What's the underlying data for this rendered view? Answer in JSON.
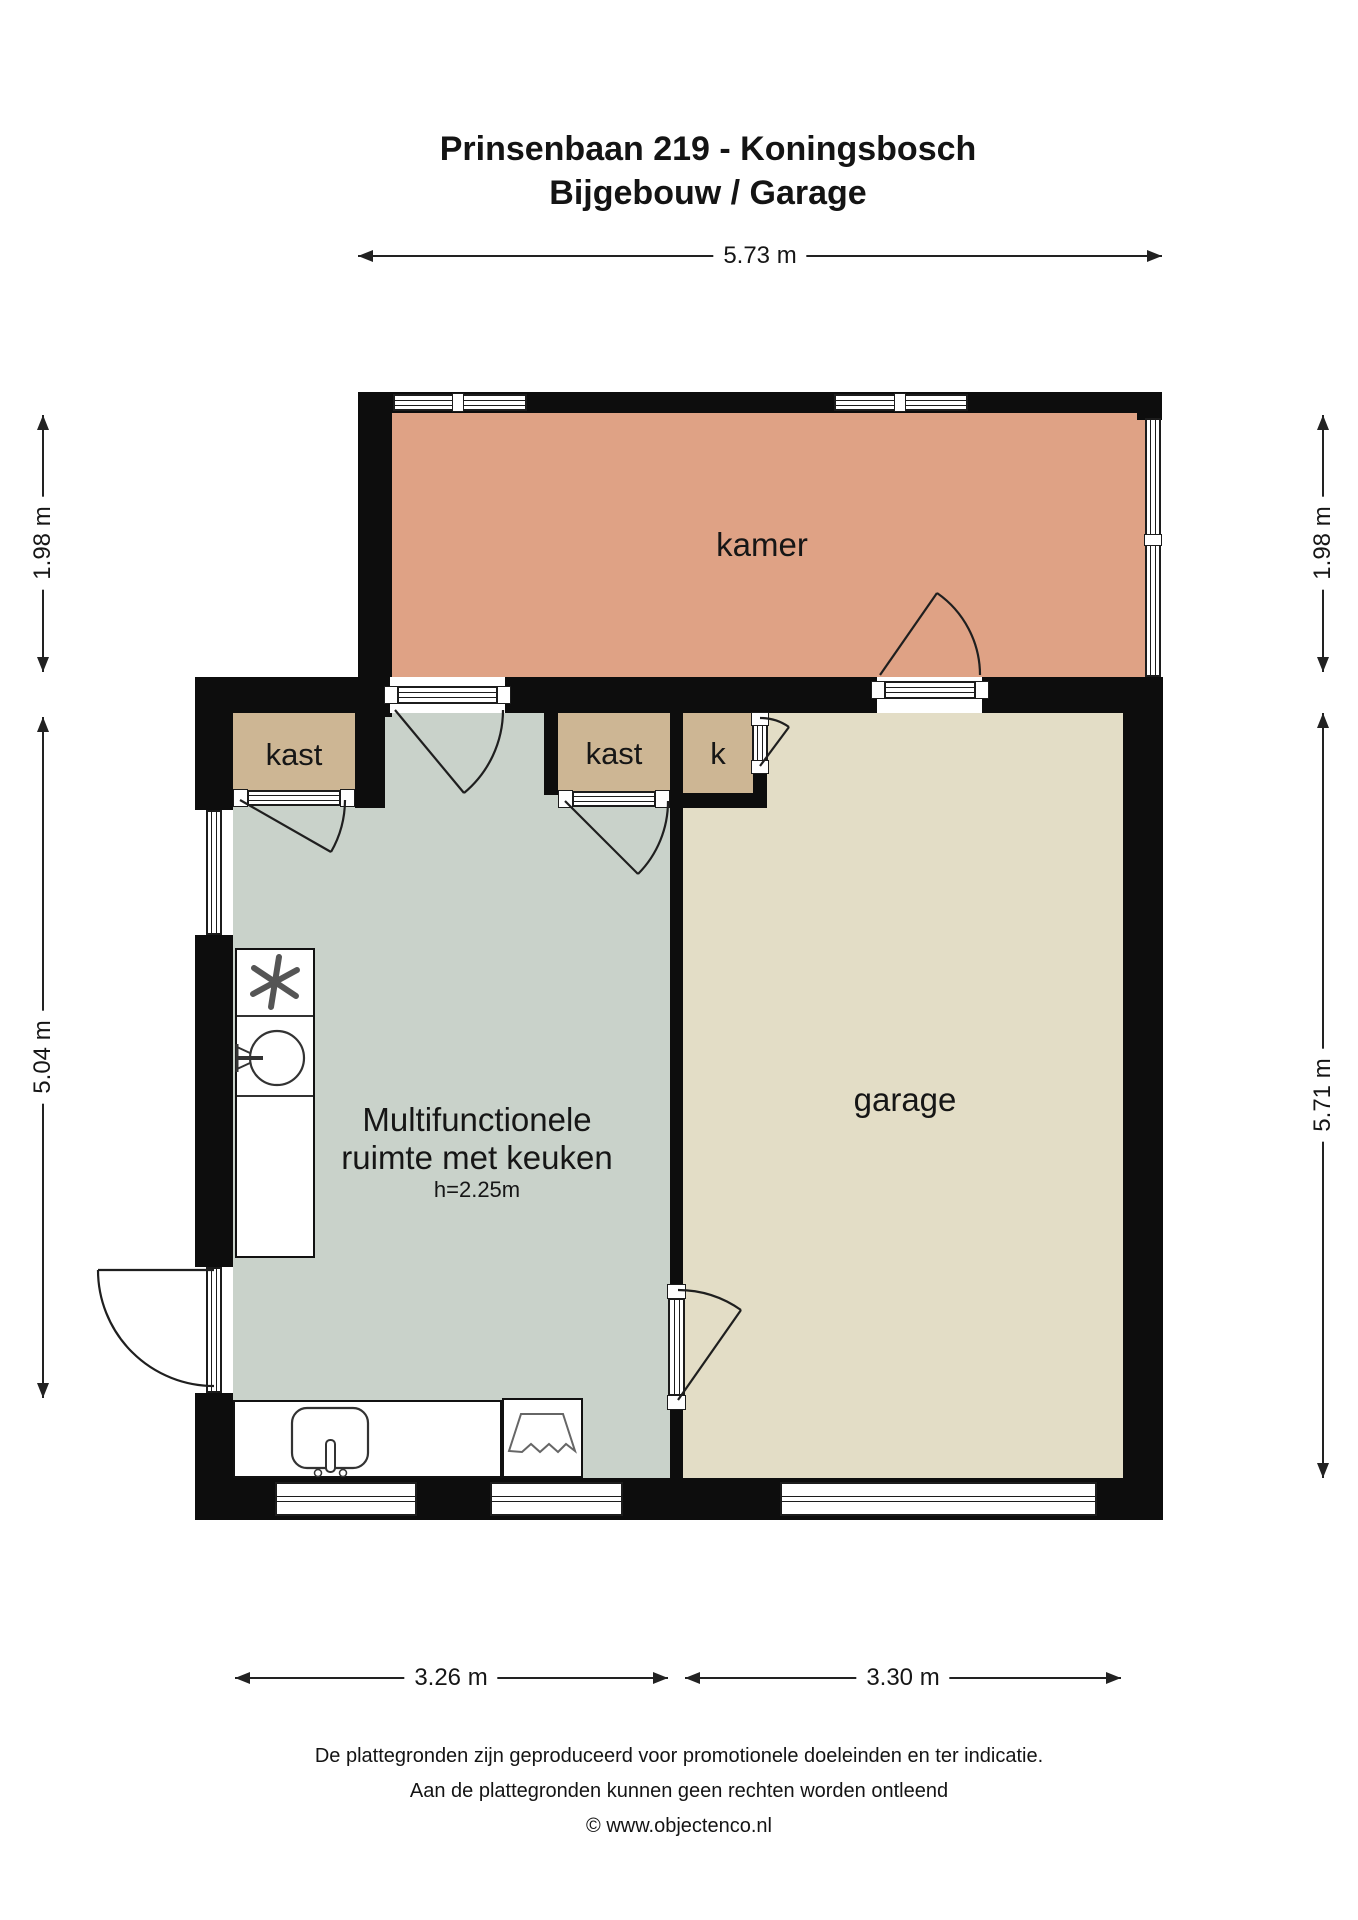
{
  "title": {
    "line1": "Prinsenbaan 219 - Koningsbosch",
    "line2": "Bijgebouw / Garage"
  },
  "rooms": {
    "kamer": "kamer",
    "garage": "garage",
    "multi_line1": "Multifunctionele",
    "multi_line2": "ruimte met keuken",
    "multi_height": "h=2.25m",
    "kast_left": "kast",
    "kast_mid": "kast",
    "k_room": "k"
  },
  "dimensions": {
    "top_width": "5.73 m",
    "left_upper": "1.98 m",
    "left_lower": "5.04 m",
    "right_upper": "1.98 m",
    "right_lower": "5.71 m",
    "bottom_left": "3.26 m",
    "bottom_right": "3.30 m"
  },
  "footer": {
    "line1": "De plattegronden zijn geproduceerd voor promotionele doeleinden en ter indicatie.",
    "line2": "Aan de plattegronden kunnen geen rechten worden ontleend",
    "line3": "© www.objectenco.nl"
  },
  "colors": {
    "kamer": "#dfa285",
    "multi": "#c9d2ca",
    "garage": "#e3ddc6",
    "closet": "#cdb694",
    "wall": "#0d0d0d"
  }
}
